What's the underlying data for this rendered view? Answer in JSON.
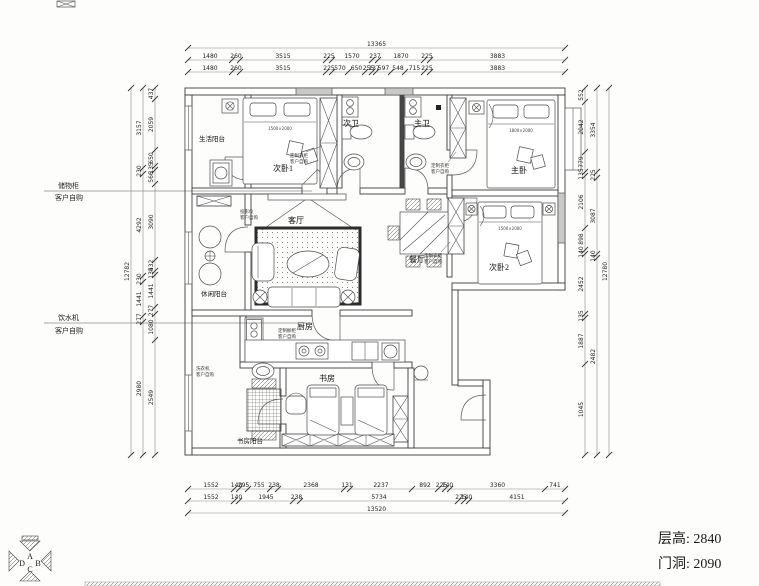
{
  "rooms": [
    {
      "id": "living-balcony",
      "label": "生活阳台"
    },
    {
      "id": "bedroom-1",
      "label": "次卧1"
    },
    {
      "id": "second-bath",
      "label": "次卫"
    },
    {
      "id": "master-bath",
      "label": "主卫"
    },
    {
      "id": "master-bedroom",
      "label": "主卧"
    },
    {
      "id": "dining-room",
      "label": "餐厅"
    },
    {
      "id": "bedroom-2",
      "label": "次卧2"
    },
    {
      "id": "living-room",
      "label": "客厅"
    },
    {
      "id": "leisure-balcony",
      "label": "休闲阳台"
    },
    {
      "id": "kitchen",
      "label": "厨房"
    },
    {
      "id": "study",
      "label": "书房"
    },
    {
      "id": "study-balcony",
      "label": "书房阳台"
    }
  ],
  "callouts": {
    "storage": {
      "line1": "储物柜",
      "line2": "客户自购"
    },
    "water": {
      "line1": "饮水机",
      "line2": "客户自购"
    },
    "wardrobe": {
      "line1": "定制衣柜",
      "line2": "客户自购"
    },
    "projector": {
      "line1": "投影仪",
      "line2": "客户自购"
    },
    "washer": {
      "line1": "洗衣机",
      "line2": "客户自购"
    },
    "cabinet": {
      "line1": "定制橱柜",
      "line2": "客户自购"
    }
  },
  "beds": {
    "bedroom1_size": "1500×2000",
    "master_size": "1800×2000",
    "bedroom2_size": "1500×2000"
  },
  "title_block": {
    "floor_height": "层高: 2840",
    "door_opening": "门洞: 2090"
  },
  "logo": {
    "letters": {
      "a": "A",
      "b": "B",
      "c": "C",
      "d": "D"
    }
  },
  "dims": {
    "top_overall": [
      "13365"
    ],
    "top_a": [
      "1480",
      "260",
      "3515",
      "225",
      "1570",
      "237",
      "1870",
      "225",
      "3883"
    ],
    "top_b": [
      "1480",
      "260",
      "3515",
      "225",
      "570",
      "650",
      "255",
      "137",
      "597",
      "548",
      "715",
      "225",
      "3883"
    ],
    "bottom_a": [
      "1552",
      "140",
      "295",
      "755",
      "238",
      "2368",
      "131",
      "2237",
      "892",
      "225",
      "140",
      "3360",
      "741"
    ],
    "bottom_b": [
      "1552",
      "140",
      "1945",
      "238",
      "5734",
      "225",
      "140",
      "4151"
    ],
    "bottom_overall": [
      "13520"
    ],
    "left_outer": [
      "3157",
      "230",
      "4292",
      "230",
      "1441",
      "277",
      "2980"
    ],
    "left_inner": [
      "437",
      "2059",
      "650",
      "135",
      "566",
      "3090",
      "432",
      "135",
      "1441",
      "277",
      "1080",
      "2549"
    ],
    "left_overall": [
      "12782"
    ],
    "right_inner": [
      "552",
      "2042",
      "779",
      "135",
      "2106",
      "898",
      "140",
      "2452",
      "135",
      "1887",
      "1045"
    ],
    "right_outer": [
      "3354",
      "225",
      "3087",
      "140",
      "2482"
    ],
    "right_overall": [
      "12780"
    ]
  }
}
